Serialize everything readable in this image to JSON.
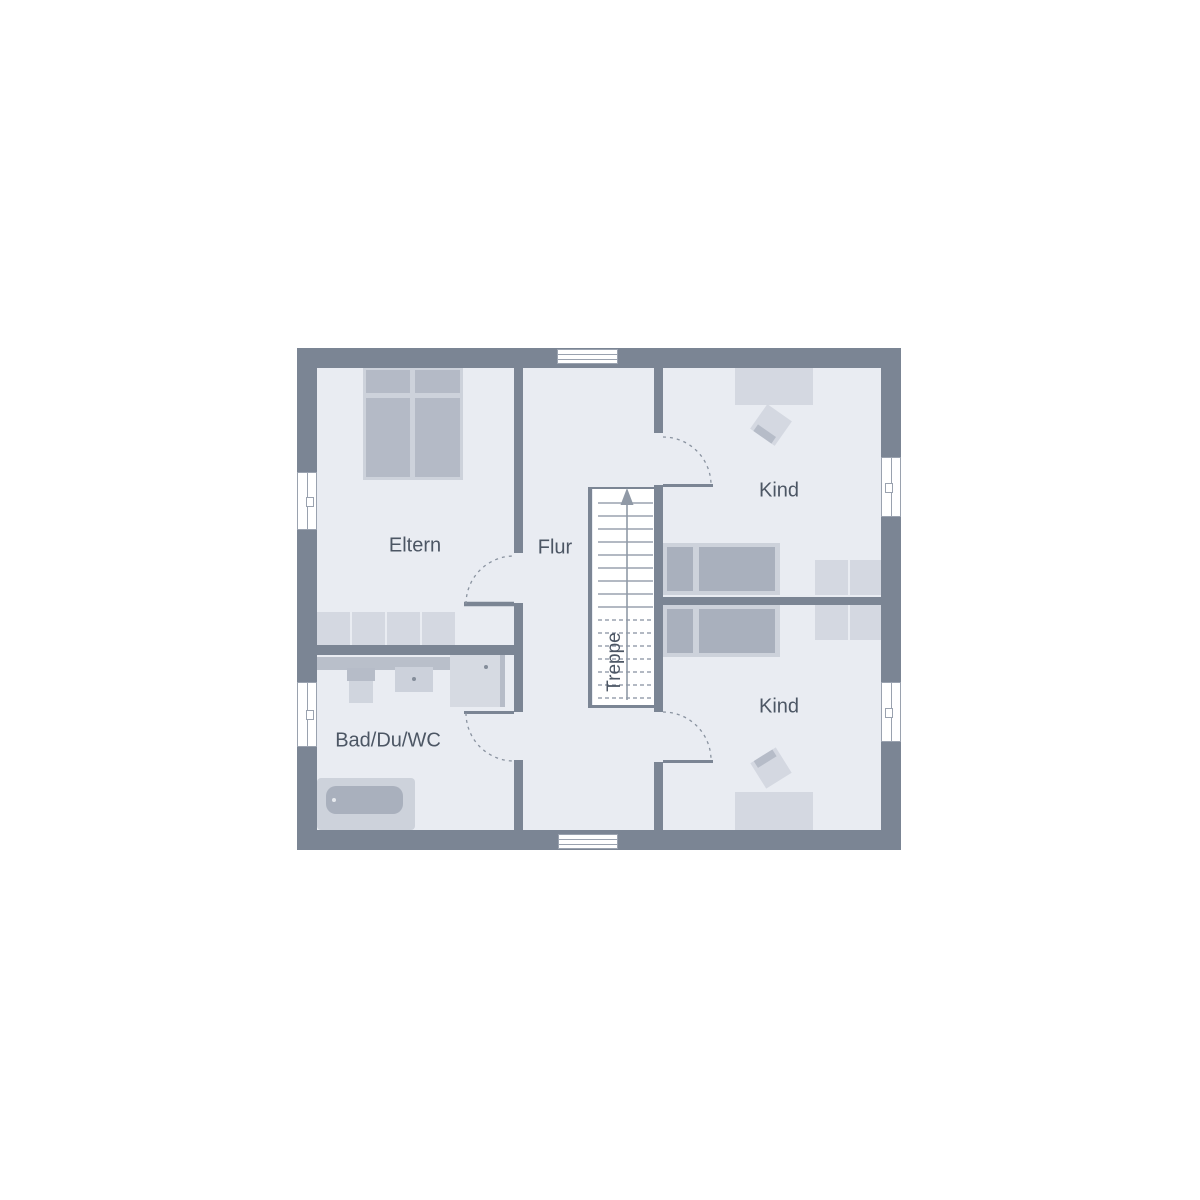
{
  "plan": {
    "type": "floor-plan",
    "rooms": [
      {
        "key": "eltern",
        "label": "Eltern"
      },
      {
        "key": "flur",
        "label": "Flur"
      },
      {
        "key": "kind_top",
        "label": "Kind"
      },
      {
        "key": "kind_bottom",
        "label": "Kind"
      },
      {
        "key": "bad",
        "label": "Bad/Du/WC"
      },
      {
        "key": "treppe",
        "label": "Treppe"
      }
    ]
  },
  "colors": {
    "background": "#ffffff",
    "wall": "#7b8594",
    "floor": "#e9ecf2",
    "furniture-light": "#d4d8e1",
    "furniture-medium": "#b6bcc8",
    "bed-frame": "#cdd2db",
    "bed-inner": "#a9b0bd",
    "counter": "#b9bfca",
    "text": "#4c5664",
    "step-line": "#9aa2af",
    "arrow": "#9099a6",
    "window-frame": "#9aa2af",
    "door-arc": "#8a93a0"
  }
}
